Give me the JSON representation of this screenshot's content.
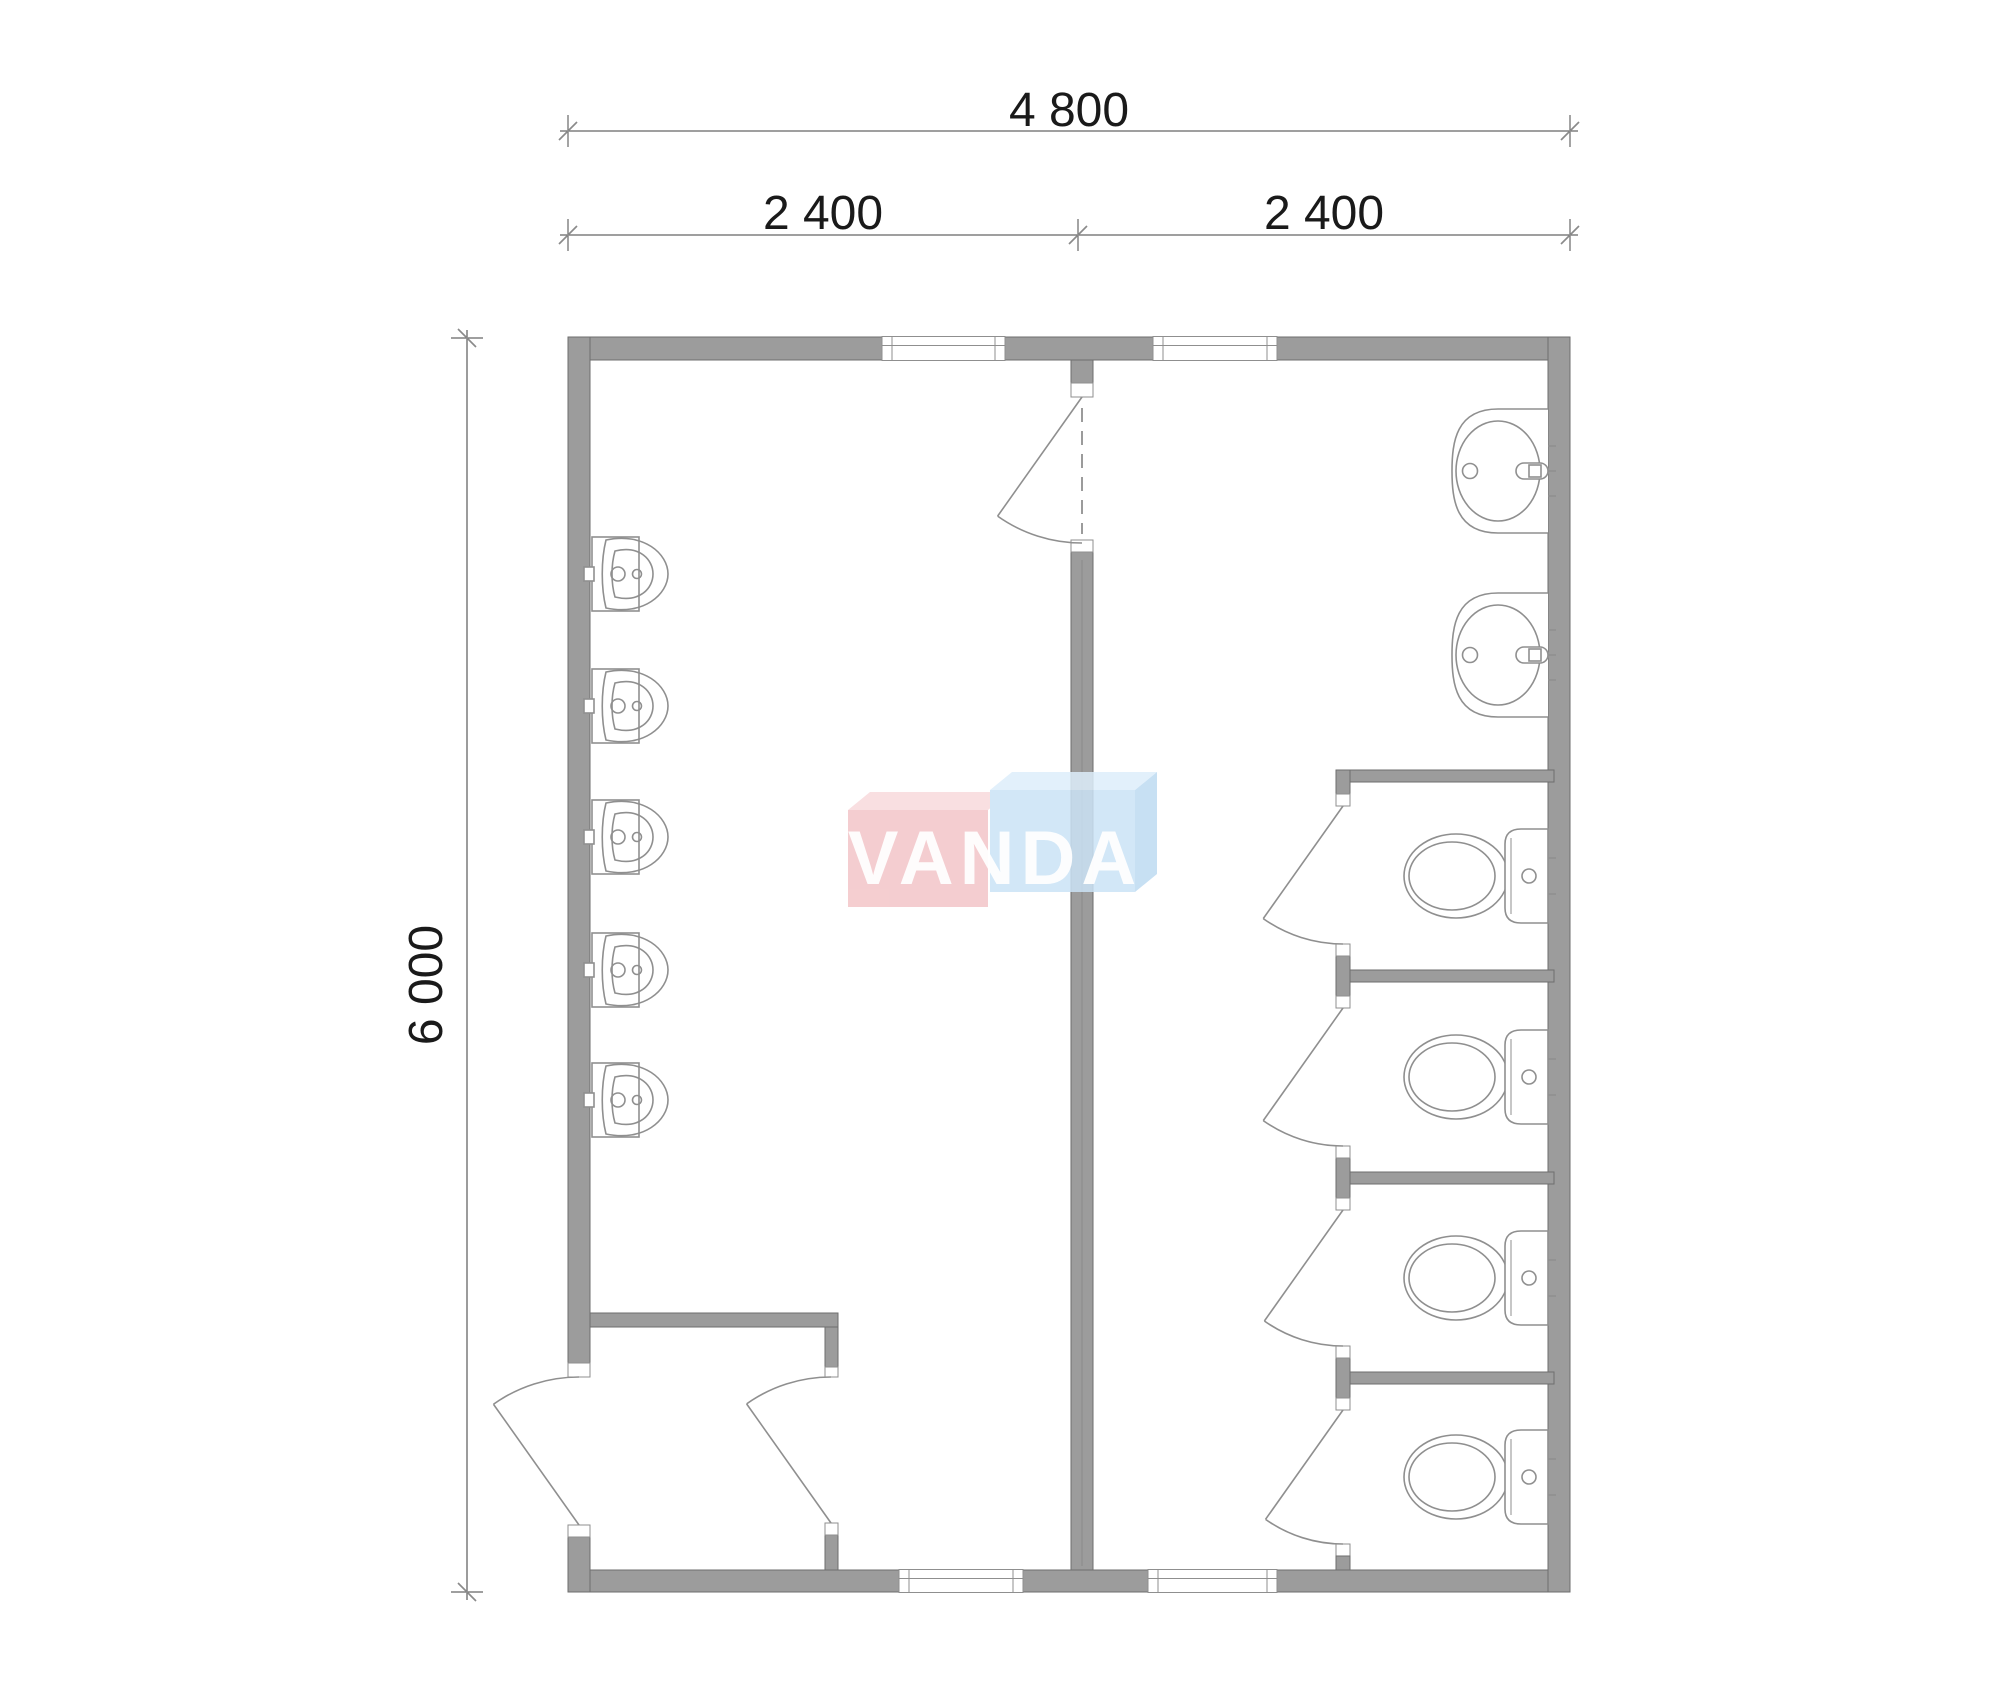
{
  "page": {
    "background": "#ffffff",
    "type": "architectural floor plan"
  },
  "dimensions": {
    "top_total": "4 800",
    "span_left": "2 400",
    "span_right": "2 400",
    "side_total": "6 000"
  },
  "watermark": {
    "text": "VANDA",
    "pink_front": "#f3c5c8",
    "pink_top": "#f8dadc",
    "blue_front": "#cbe3f6",
    "blue_top": "#ddeefb",
    "blue_side": "#bedbf2",
    "text_color": "#ffffff",
    "opacity": 0.85
  },
  "palette": {
    "wall_fill": "#9c9c9c",
    "wall_edge": "#6e6e6e",
    "jamb_fill": "#ffffff",
    "fixture_line": "#8f8f8f",
    "dim_line": "#666666",
    "dim_slash": "#8a8a8a",
    "dim_text": "#1a1a1a",
    "dash_line": "#7a7a7a"
  },
  "fixture_counts": {
    "urinals": 5,
    "wash_basins": 2,
    "toilets": 4,
    "doors": 7,
    "windows": 4
  },
  "plan": {
    "building": {
      "x": 568,
      "y": 337,
      "w": 1002,
      "h": 1255,
      "wall": 22,
      "top_wall": 23
    },
    "central_wall": {
      "x": 1071,
      "w": 22,
      "stub_h": 23,
      "jamb1_y": 383,
      "door_top": 397,
      "door_bottom": 540,
      "jamb2_h": 12,
      "body_y": 552
    },
    "windows_top": [
      {
        "x": 882,
        "w": 123
      },
      {
        "x": 1153,
        "w": 124
      }
    ],
    "windows_bottom": [
      {
        "x": 899,
        "w": 124
      },
      {
        "x": 1148,
        "w": 129
      }
    ],
    "urinals": {
      "wall_x": 590,
      "centers": [
        574,
        706,
        837,
        970,
        1100
      ]
    },
    "sinks": {
      "wall_x": 1548,
      "tops": [
        408,
        592
      ],
      "height": 126
    },
    "stalls": {
      "front_x": 1336,
      "front_w": 14,
      "right_x": 1548,
      "partitions": [
        770,
        970,
        1172,
        1372
      ],
      "partition_h": 12,
      "bottom_y": 1570,
      "door_hinges": [
        806,
        1008,
        1210,
        1410
      ],
      "door_closes": [
        944,
        1146,
        1346,
        1544
      ],
      "toilet_centers": [
        876,
        1077,
        1278,
        1477
      ]
    },
    "vestibule": {
      "wall_y": 1313,
      "wall_h": 14,
      "x1": 590,
      "x2": 838,
      "door_wall_x": 825,
      "door_wall_w": 13,
      "door_top": 1377,
      "door_bottom": 1523
    },
    "entrance": {
      "door_top": 1377,
      "door_bottom": 1525
    },
    "dims": {
      "line1_y": 131,
      "line2_y": 235,
      "vline_x": 467,
      "mid_x": 1078,
      "left_x": 568,
      "right_x": 1570,
      "top_y": 338,
      "bottom_y": 1592
    }
  }
}
